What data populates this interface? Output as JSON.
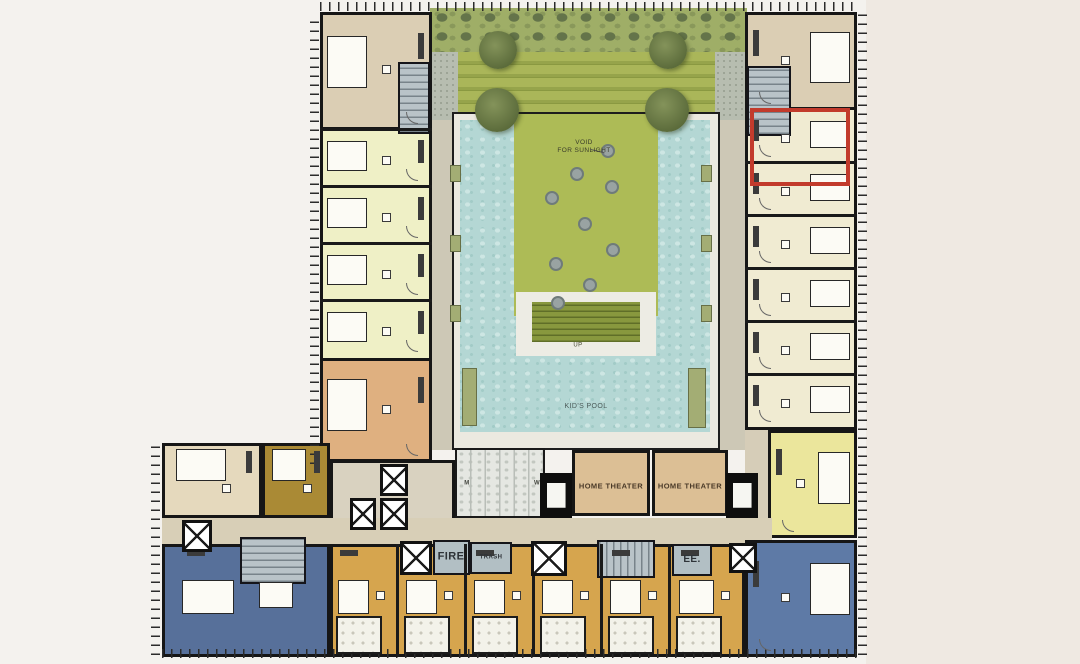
{
  "plan": {
    "name": "residential-tower-amenity-floor-plan",
    "background": "#f4f2ee",
    "highlight_color": "#c23b2c"
  },
  "labels": [
    {
      "id": "void-for-sunlight",
      "text": "VOID\nFOR SUNLIGHT",
      "x": 584,
      "y": 147,
      "size": 6.5,
      "weight": "normal",
      "color": "#3a3c2a"
    },
    {
      "id": "up",
      "text": "UP",
      "x": 578,
      "y": 346,
      "size": 6,
      "weight": "normal",
      "color": "#44462f"
    },
    {
      "id": "kids-pool",
      "text": "KID'S POOL",
      "x": 586,
      "y": 407,
      "size": 7,
      "weight": "normal",
      "color": "#4a5a58"
    },
    {
      "id": "home-theater-1",
      "text": "HOME THEATER",
      "x": 611,
      "y": 486,
      "size": 7.5,
      "weight": "bold",
      "color": "#4a3a28"
    },
    {
      "id": "home-theater-2",
      "text": "HOME THEATER",
      "x": 690,
      "y": 486,
      "size": 7.5,
      "weight": "bold",
      "color": "#4a3a28"
    },
    {
      "id": "fire",
      "text": "FIRE",
      "x": 451,
      "y": 557,
      "size": 11,
      "weight": "bold",
      "color": "#2e3338"
    },
    {
      "id": "trash",
      "text": "TRASH",
      "x": 491,
      "y": 558,
      "size": 6,
      "weight": "bold",
      "color": "#2e3338"
    },
    {
      "id": "ee",
      "text": "EE.",
      "x": 692,
      "y": 560,
      "size": 10,
      "weight": "bold",
      "color": "#2e3338"
    },
    {
      "id": "mens-restroom",
      "text": "M",
      "x": 467,
      "y": 484,
      "size": 6,
      "weight": "bold",
      "color": "#44463f"
    },
    {
      "id": "womens-restroom",
      "text": "W",
      "x": 537,
      "y": 484,
      "size": 6,
      "weight": "bold",
      "color": "#44463f"
    }
  ],
  "zones": [
    {
      "name": "background-right-margin",
      "x": 866,
      "y": 0,
      "w": 214,
      "h": 664,
      "fill": "#efe9e2"
    },
    {
      "name": "roof-terrace",
      "x": 430,
      "y": 8,
      "w": 317,
      "h": 112,
      "fill": "#b7c183"
    },
    {
      "name": "terrace-hedge",
      "x": 430,
      "y": 8,
      "w": 317,
      "h": 44,
      "cls": "hedge"
    },
    {
      "name": "terrace-planting-bands",
      "x": 458,
      "y": 52,
      "w": 257,
      "h": 68,
      "cls": "stripes"
    },
    {
      "name": "terrace-paving-left",
      "x": 432,
      "y": 52,
      "w": 26,
      "h": 68,
      "cls": "paving"
    },
    {
      "name": "terrace-paving-right",
      "x": 715,
      "y": 52,
      "w": 32,
      "h": 68,
      "cls": "paving"
    },
    {
      "name": "corridor-left",
      "x": 432,
      "y": 120,
      "w": 23,
      "h": 330,
      "fill": "#cdc8b6"
    },
    {
      "name": "corridor-right",
      "x": 712,
      "y": 120,
      "w": 33,
      "h": 330,
      "fill": "#cdc8b6"
    },
    {
      "name": "pool-deck",
      "x": 452,
      "y": 112,
      "w": 268,
      "h": 338,
      "fill": "#ebe9e0",
      "border": "2px solid #1d1d1d"
    },
    {
      "name": "swimming-pool",
      "x": 460,
      "y": 120,
      "w": 250,
      "h": 312,
      "cls": "pool"
    },
    {
      "name": "green-island",
      "x": 514,
      "y": 114,
      "w": 144,
      "h": 202,
      "fill": "#adbb56"
    },
    {
      "name": "island-steps-deck",
      "x": 516,
      "y": 292,
      "w": 140,
      "h": 64,
      "fill": "#edece4"
    },
    {
      "name": "island-steps",
      "x": 532,
      "y": 302,
      "w": 108,
      "h": 40,
      "cls": "steps"
    },
    {
      "name": "left-wing-units",
      "x": 320,
      "y": 12,
      "w": 112,
      "h": 450,
      "fill": "#eff0c6",
      "border": "3px solid #161616"
    },
    {
      "name": "left-wing-corner-unit",
      "x": 320,
      "y": 12,
      "w": 112,
      "h": 118,
      "fill": "#dbceb4",
      "border": "3px solid #161616"
    },
    {
      "name": "stair-top-left",
      "x": 398,
      "y": 62,
      "w": 32,
      "h": 72,
      "cls": "stair stair-h"
    },
    {
      "name": "left-wing-tan-unit",
      "x": 320,
      "y": 358,
      "w": 112,
      "h": 104,
      "fill": "#dfb080",
      "border": "3px solid #161616"
    },
    {
      "name": "right-wing-units",
      "x": 745,
      "y": 12,
      "w": 112,
      "h": 418,
      "fill": "#f0ebd2",
      "border": "3px solid #161616"
    },
    {
      "name": "right-wing-corner-unit",
      "x": 745,
      "y": 12,
      "w": 112,
      "h": 98,
      "fill": "#dbceb4",
      "border": "3px solid #161616"
    },
    {
      "name": "stair-top-right",
      "x": 747,
      "y": 66,
      "w": 44,
      "h": 70,
      "cls": "stair stair-h"
    },
    {
      "name": "right-wing-corridor",
      "x": 745,
      "y": 430,
      "w": 25,
      "h": 112,
      "fill": "#d6cdb8"
    },
    {
      "name": "right-wing-yellow-unit",
      "x": 768,
      "y": 430,
      "w": 89,
      "h": 108,
      "fill": "#ebe69c",
      "border": "3px solid #161616"
    },
    {
      "name": "bottom-wing-cream-unit",
      "x": 162,
      "y": 443,
      "w": 100,
      "h": 75,
      "fill": "#e5d9bd",
      "border": "3px solid #161616"
    },
    {
      "name": "bottom-wing-olive-unit",
      "x": 262,
      "y": 443,
      "w": 68,
      "h": 75,
      "fill": "#aa8a35",
      "border": "3px solid #161616"
    },
    {
      "name": "elevator-lobby",
      "x": 330,
      "y": 460,
      "w": 125,
      "h": 84,
      "fill": "#d9d2c0",
      "border": "3px solid #161616"
    },
    {
      "name": "corridor-bottom",
      "x": 162,
      "y": 518,
      "w": 610,
      "h": 26,
      "fill": "#d8cfb7"
    },
    {
      "name": "restrooms",
      "x": 455,
      "y": 448,
      "w": 90,
      "h": 70,
      "cls": "restroom",
      "border": "2px solid #1a1a1a"
    },
    {
      "name": "home-theater-room-1",
      "x": 572,
      "y": 450,
      "w": 78,
      "h": 66,
      "fill": "#dcbf95",
      "border": "3px solid #161616"
    },
    {
      "name": "home-theater-room-2",
      "x": 652,
      "y": 450,
      "w": 76,
      "h": 66,
      "fill": "#dcbf95",
      "border": "3px solid #161616"
    },
    {
      "name": "theater-screen-1",
      "x": 540,
      "y": 473,
      "w": 32,
      "h": 45,
      "cls": "screen"
    },
    {
      "name": "theater-screen-2",
      "x": 726,
      "y": 473,
      "w": 32,
      "h": 45,
      "cls": "screen"
    },
    {
      "name": "bottom-wing-gold-units",
      "x": 330,
      "y": 544,
      "w": 415,
      "h": 113,
      "fill": "#d6a54e",
      "border": "3px solid #161616"
    },
    {
      "name": "bottom-wing-blue-unit-left",
      "x": 162,
      "y": 544,
      "w": 168,
      "h": 113,
      "fill": "#57709a",
      "border": "3px solid #161616"
    },
    {
      "name": "bottom-wing-blue-unit-right",
      "x": 745,
      "y": 540,
      "w": 112,
      "h": 117,
      "fill": "#5e7aa6",
      "border": "3px solid #161616"
    },
    {
      "name": "stair-bottom-left",
      "x": 240,
      "y": 537,
      "w": 66,
      "h": 47,
      "cls": "stair stair-h"
    },
    {
      "name": "fire-stair-room",
      "x": 433,
      "y": 540,
      "w": 37,
      "h": 35,
      "fill": "#b2bfc4",
      "border": "2px solid #15151a"
    },
    {
      "name": "trash-room",
      "x": 470,
      "y": 542,
      "w": 42,
      "h": 32,
      "fill": "#b2bfc4",
      "border": "2px solid #15151a"
    },
    {
      "name": "stair-bottom-center",
      "x": 597,
      "y": 540,
      "w": 58,
      "h": 38,
      "cls": "stair stair-v"
    },
    {
      "name": "electrical-room",
      "x": 672,
      "y": 544,
      "w": 40,
      "h": 32,
      "fill": "#b2bfc4",
      "border": "2px solid #15151a"
    }
  ],
  "walls": [
    {
      "x": 320,
      "y": 128,
      "w": 112,
      "h": 3
    },
    {
      "x": 320,
      "y": 185,
      "w": 112,
      "h": 3
    },
    {
      "x": 320,
      "y": 242,
      "w": 112,
      "h": 3
    },
    {
      "x": 320,
      "y": 299,
      "w": 112,
      "h": 3
    },
    {
      "x": 745,
      "y": 161,
      "w": 112,
      "h": 3
    },
    {
      "x": 745,
      "y": 214,
      "w": 112,
      "h": 3
    },
    {
      "x": 745,
      "y": 267,
      "w": 112,
      "h": 3
    },
    {
      "x": 745,
      "y": 320,
      "w": 112,
      "h": 3
    },
    {
      "x": 745,
      "y": 373,
      "w": 112,
      "h": 3
    },
    {
      "x": 396,
      "y": 544,
      "w": 3,
      "h": 113
    },
    {
      "x": 464,
      "y": 544,
      "w": 3,
      "h": 113
    },
    {
      "x": 532,
      "y": 544,
      "w": 3,
      "h": 113
    },
    {
      "x": 600,
      "y": 544,
      "w": 3,
      "h": 113
    },
    {
      "x": 668,
      "y": 544,
      "w": 3,
      "h": 113
    }
  ],
  "units": [
    {
      "x": 320,
      "y": 12,
      "w": 112,
      "h": 118,
      "facing": "left"
    },
    {
      "x": 320,
      "y": 130,
      "w": 112,
      "h": 57,
      "facing": "left"
    },
    {
      "x": 320,
      "y": 187,
      "w": 112,
      "h": 57,
      "facing": "left"
    },
    {
      "x": 320,
      "y": 244,
      "w": 112,
      "h": 57,
      "facing": "left"
    },
    {
      "x": 320,
      "y": 301,
      "w": 112,
      "h": 57,
      "facing": "left"
    },
    {
      "x": 320,
      "y": 358,
      "w": 112,
      "h": 104,
      "facing": "left"
    },
    {
      "x": 745,
      "y": 12,
      "w": 112,
      "h": 98,
      "facing": "right"
    },
    {
      "x": 745,
      "y": 110,
      "w": 112,
      "h": 53,
      "facing": "right"
    },
    {
      "x": 745,
      "y": 163,
      "w": 112,
      "h": 53,
      "facing": "right"
    },
    {
      "x": 745,
      "y": 216,
      "w": 112,
      "h": 53,
      "facing": "right"
    },
    {
      "x": 745,
      "y": 269,
      "w": 112,
      "h": 53,
      "facing": "right"
    },
    {
      "x": 745,
      "y": 322,
      "w": 112,
      "h": 53,
      "facing": "right"
    },
    {
      "x": 745,
      "y": 375,
      "w": 112,
      "h": 53,
      "facing": "right"
    },
    {
      "x": 768,
      "y": 430,
      "w": 89,
      "h": 108,
      "facing": "right"
    },
    {
      "x": 745,
      "y": 540,
      "w": 112,
      "h": 117,
      "facing": "right"
    },
    {
      "x": 162,
      "y": 443,
      "w": 100,
      "h": 75,
      "facing": "top"
    },
    {
      "x": 262,
      "y": 443,
      "w": 68,
      "h": 75,
      "facing": "top"
    },
    {
      "x": 162,
      "y": 544,
      "w": 168,
      "h": 113,
      "facing": "bottom"
    },
    {
      "x": 330,
      "y": 544,
      "w": 68,
      "h": 113,
      "facing": "bottom"
    },
    {
      "x": 398,
      "y": 544,
      "w": 68,
      "h": 113,
      "facing": "bottom"
    },
    {
      "x": 466,
      "y": 544,
      "w": 68,
      "h": 113,
      "facing": "bottom"
    },
    {
      "x": 534,
      "y": 544,
      "w": 68,
      "h": 113,
      "facing": "bottom"
    },
    {
      "x": 602,
      "y": 544,
      "w": 68,
      "h": 113,
      "facing": "bottom"
    },
    {
      "x": 670,
      "y": 544,
      "w": 75,
      "h": 113,
      "facing": "bottom"
    }
  ],
  "elevators": [
    {
      "x": 350,
      "y": 498,
      "w": 26,
      "h": 32
    },
    {
      "x": 380,
      "y": 464,
      "w": 28,
      "h": 32
    },
    {
      "x": 380,
      "y": 498,
      "w": 28,
      "h": 32
    },
    {
      "x": 182,
      "y": 520,
      "w": 30,
      "h": 32
    },
    {
      "x": 400,
      "y": 541,
      "w": 32,
      "h": 34
    },
    {
      "x": 531,
      "y": 541,
      "w": 36,
      "h": 35
    },
    {
      "x": 729,
      "y": 543,
      "w": 28,
      "h": 30
    }
  ],
  "pods": [
    {
      "x": 336,
      "y": 616,
      "w": 46,
      "h": 38
    },
    {
      "x": 404,
      "y": 616,
      "w": 46,
      "h": 38
    },
    {
      "x": 472,
      "y": 616,
      "w": 46,
      "h": 38
    },
    {
      "x": 540,
      "y": 616,
      "w": 46,
      "h": 38
    },
    {
      "x": 608,
      "y": 616,
      "w": 46,
      "h": 38
    },
    {
      "x": 676,
      "y": 616,
      "w": 46,
      "h": 38
    }
  ],
  "columns": [
    {
      "x": 450,
      "y": 165,
      "w": 11,
      "h": 17
    },
    {
      "x": 450,
      "y": 235,
      "w": 11,
      "h": 17
    },
    {
      "x": 450,
      "y": 305,
      "w": 11,
      "h": 17
    },
    {
      "x": 701,
      "y": 165,
      "w": 11,
      "h": 17
    },
    {
      "x": 701,
      "y": 235,
      "w": 11,
      "h": 17
    },
    {
      "x": 701,
      "y": 305,
      "w": 11,
      "h": 17
    },
    {
      "x": 688,
      "y": 368,
      "w": 18,
      "h": 60
    },
    {
      "x": 462,
      "y": 368,
      "w": 15,
      "h": 58
    }
  ],
  "skylight_circles": [
    {
      "cx": 608,
      "cy": 151
    },
    {
      "cx": 577,
      "cy": 174
    },
    {
      "cx": 612,
      "cy": 187
    },
    {
      "cx": 552,
      "cy": 198
    },
    {
      "cx": 585,
      "cy": 224
    },
    {
      "cx": 613,
      "cy": 250
    },
    {
      "cx": 556,
      "cy": 264
    },
    {
      "cx": 590,
      "cy": 285
    },
    {
      "cx": 558,
      "cy": 303
    }
  ],
  "trees": [
    {
      "cx": 498,
      "cy": 50,
      "d": 38
    },
    {
      "cx": 668,
      "cy": 50,
      "d": 38
    },
    {
      "cx": 497,
      "cy": 110,
      "d": 44
    },
    {
      "cx": 667,
      "cy": 110,
      "d": 44
    }
  ],
  "leader_lines": [
    {
      "x": 591,
      "y": 149,
      "len": 14,
      "deg": 14
    }
  ],
  "ticks": [
    {
      "x": 320,
      "y": 2,
      "w": 537,
      "h": 9,
      "dir": "v"
    },
    {
      "x": 310,
      "y": 14,
      "w": 9,
      "h": 450,
      "dir": "h"
    },
    {
      "x": 151,
      "y": 443,
      "w": 9,
      "h": 212,
      "dir": "h"
    },
    {
      "x": 162,
      "y": 649,
      "w": 696,
      "h": 9,
      "dir": "v"
    },
    {
      "x": 858,
      "y": 14,
      "w": 9,
      "h": 641,
      "dir": "h"
    }
  ],
  "highlight": {
    "name": "selected-unit-outline",
    "x": 750,
    "y": 108,
    "w": 100,
    "h": 78,
    "stroke": 4,
    "color": "#c23b2c"
  }
}
